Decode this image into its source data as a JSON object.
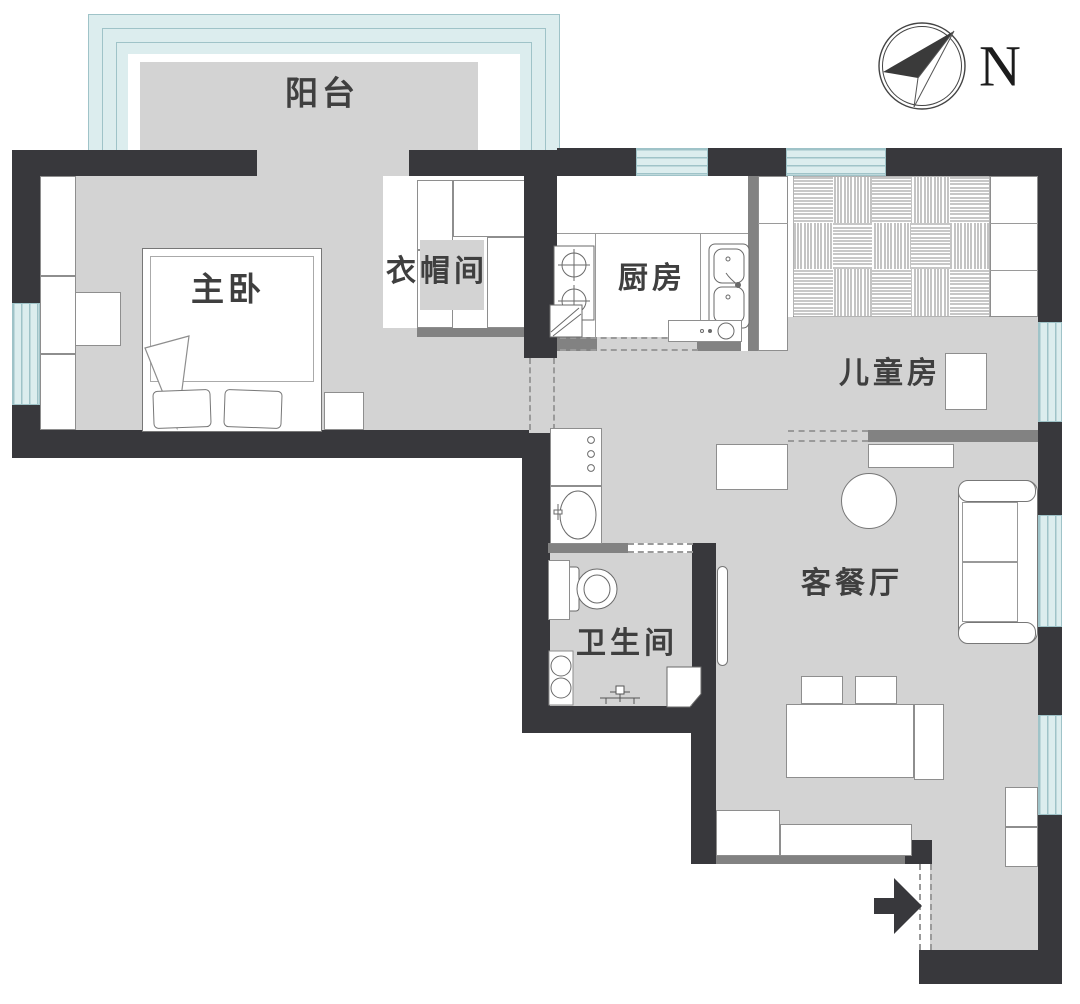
{
  "plan": {
    "type": "apartment-floor-plan",
    "rooms": {
      "balcony": "阳台",
      "master_bedroom": "主卧",
      "cloakroom": "衣帽间",
      "kitchen": "厨房",
      "kids_room": "儿童房",
      "living_dining": "客餐厅",
      "bathroom": "卫生间"
    },
    "compass": {
      "label": "N"
    },
    "colors": {
      "wall": "#38383c",
      "partition": "#828282",
      "floor": "#d3d3d3",
      "window_fill": "#dcedee",
      "window_line": "#9fc3c8",
      "furniture_outline": "#8e8e8e",
      "label_text": "#3f3f3f"
    },
    "icons": [
      "compass-icon",
      "entry-arrow-icon",
      "stove-icon",
      "sink-icon",
      "fridge-icon",
      "washing-machine-icon",
      "basin-icon",
      "toilet-icon",
      "shower-icon",
      "bed-icon",
      "pillow-icon",
      "sofa-icon",
      "dining-table-icon",
      "round-table-icon",
      "woven-bed-platform-icon"
    ]
  }
}
